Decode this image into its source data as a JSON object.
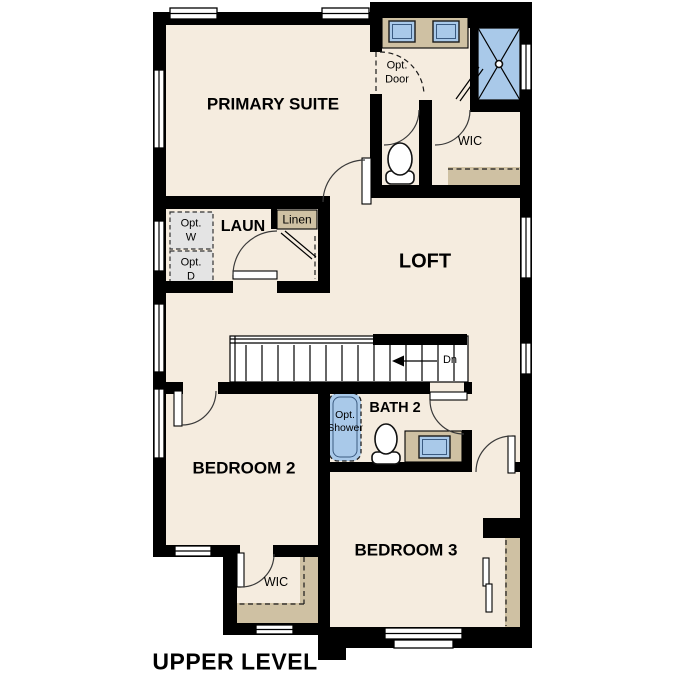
{
  "plan": {
    "title": "UPPER LEVEL",
    "rooms": {
      "primary_suite": "PRIMARY SUITE",
      "loft": "LOFT",
      "laundry": "LAUN",
      "linen": "Linen",
      "primary_wic": "WIC",
      "bath2": "BATH 2",
      "bedroom2": "BEDROOM 2",
      "bedroom3": "BEDROOM 3",
      "bedroom2_wic": "WIC"
    },
    "options": {
      "door": [
        "Opt.",
        "Door"
      ],
      "washer": [
        "Opt.",
        "W"
      ],
      "dryer": [
        "Opt.",
        "D"
      ],
      "shower": [
        "Opt.",
        "Shower"
      ]
    },
    "stairs": {
      "direction_label": "Dn"
    },
    "colors": {
      "background": "#ffffff",
      "floor": "#f5ecdf",
      "wall": "#000000",
      "fixture_blue": "#a9c9e9",
      "counter_tan": "#cfc1a3",
      "appliance_gray": "#e4e4e4",
      "stair_white": "#ffffff"
    }
  }
}
